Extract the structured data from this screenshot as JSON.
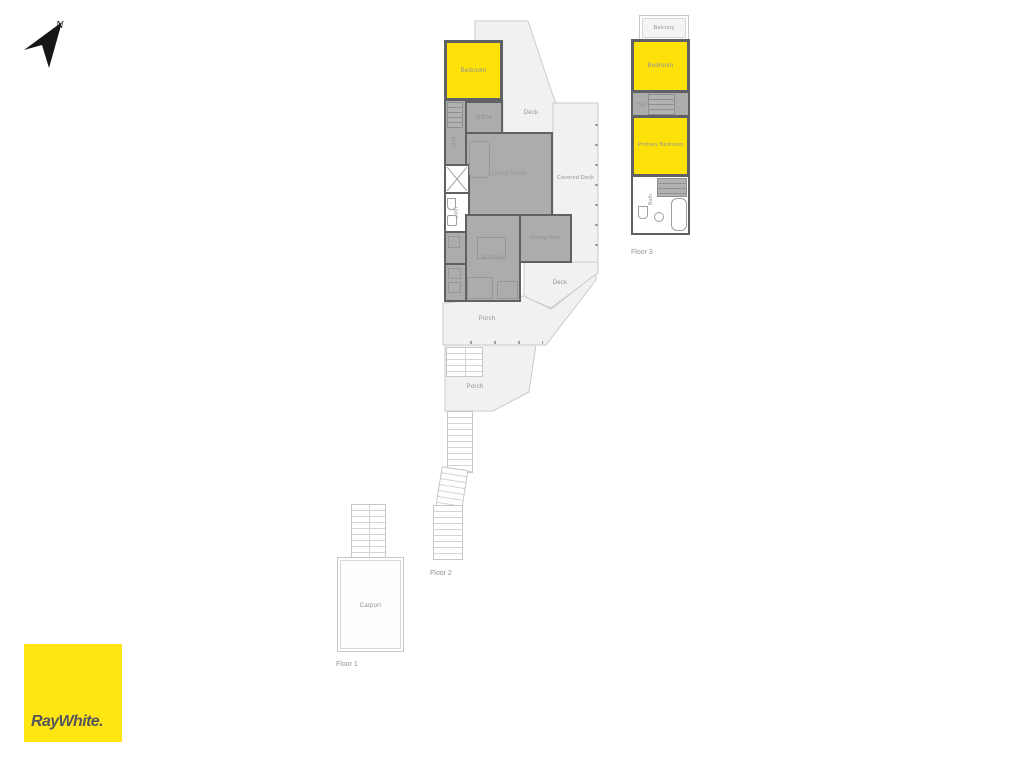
{
  "compass": {
    "north_label": "N"
  },
  "colors": {
    "accent_yellow": "#FFE10A",
    "room_gray": "#ACACAC",
    "wall_dark": "#5F6165",
    "outdoor_fill": "#F1F1F2",
    "label_gray": "#8D9398",
    "logo_yellow": "#FFE512",
    "logo_text": "#54565C"
  },
  "floor2": {
    "floor_label": "Floor 2",
    "rooms": {
      "bedroom": "Bedroom",
      "office": "Office",
      "hall": "Hall",
      "living_room": "Living Room",
      "bath": "Bath",
      "kitchen": "Kitchen",
      "dining_area": "Dining Area"
    },
    "outdoor": {
      "deck_top": "Deck",
      "covered_deck": "Covered Deck",
      "deck_bottom": "Deck",
      "porch_upper": "Porch",
      "porch_lower": "Porch"
    }
  },
  "floor3": {
    "floor_label": "Floor 3",
    "rooms": {
      "balcony": "Balcony",
      "bedroom": "Bedroom",
      "hall": "Hall",
      "primary_bedroom": "Primary Bedroom",
      "bath": "Bath"
    }
  },
  "floor1": {
    "floor_label": "Floor 1",
    "rooms": {
      "carport": "Carport"
    }
  },
  "logo": {
    "brand": "RayWhite."
  }
}
